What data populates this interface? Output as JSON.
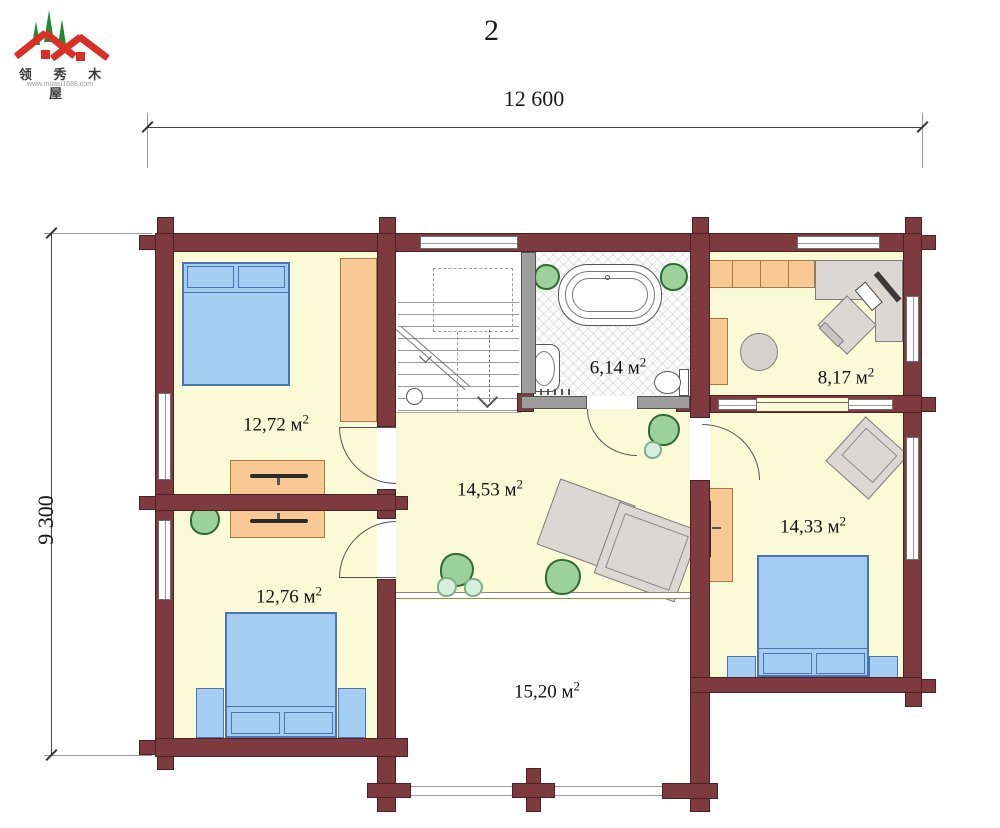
{
  "page": {
    "title": "2"
  },
  "logo": {
    "name": "领 秀 木 屋",
    "url": "www.muwu1688.com",
    "roof_color": "#d93025",
    "tree_color": "#1d8c2e"
  },
  "dimensions": {
    "width_label": "12 600",
    "height_label": "9 300"
  },
  "unit": {
    "symbol": "м",
    "sup": "2"
  },
  "rooms": {
    "bedroom_top_left": {
      "area": "12,72"
    },
    "bedroom_bottom_left": {
      "area": "12,76"
    },
    "hall": {
      "area": "14,53"
    },
    "bathroom": {
      "area": "6,14"
    },
    "study": {
      "area": "8,17"
    },
    "bedroom_right": {
      "area": "14,33"
    },
    "balcony": {
      "area": "15,20"
    }
  },
  "colors": {
    "wall": "#7d3b40",
    "partition_gray": "#9d9d9d",
    "floor": "#fafad6",
    "bed": "#a5cdf2",
    "furniture_orange": "#f8c994",
    "furniture_gray": "#dbd8d4",
    "plant": "#9cd199"
  }
}
